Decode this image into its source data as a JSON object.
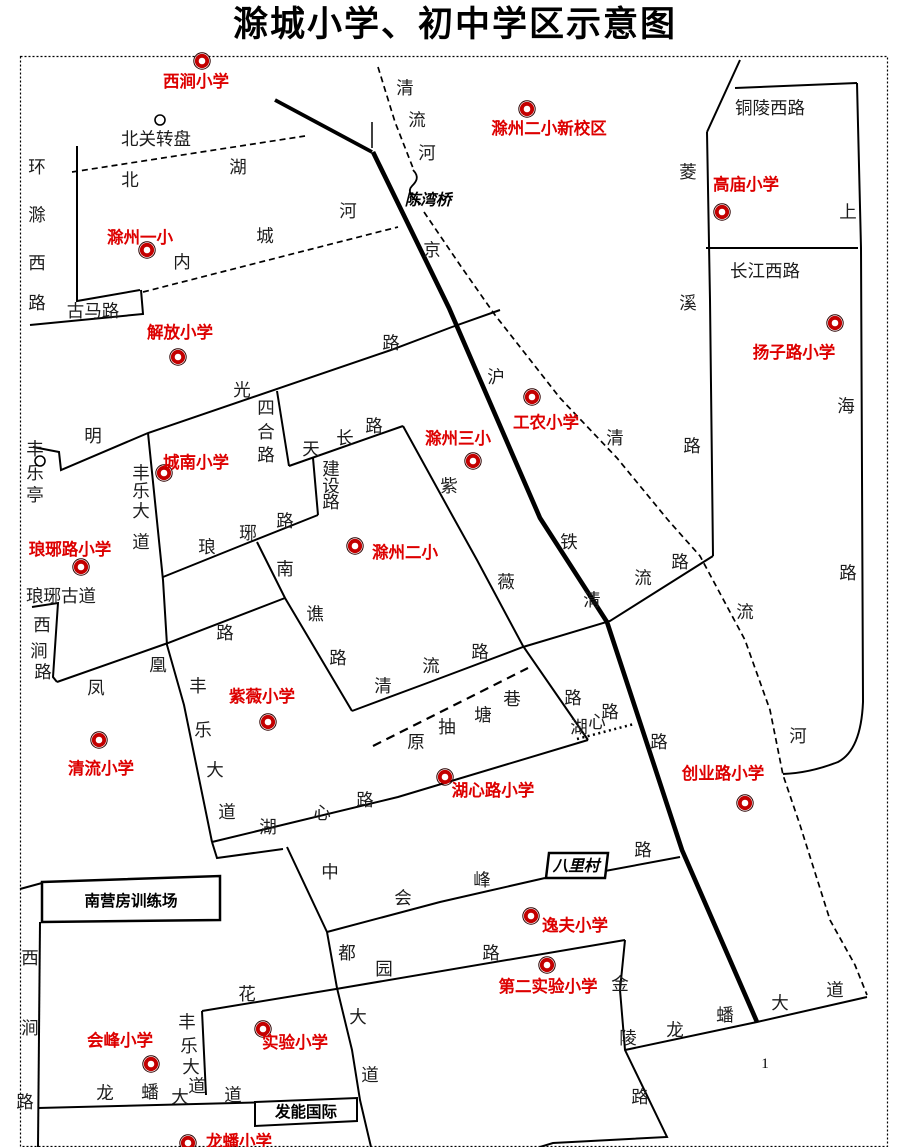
{
  "title": "滁城小学、初中学区示意图",
  "page_number": "1",
  "colors": {
    "school_label_red": "#dd0000",
    "school_marker_red": "#c40000",
    "road_line_black": "#000000",
    "road_label_gray": "#1c1c1c",
    "background": "#ffffff"
  },
  "schools": [
    {
      "name": "西涧小学",
      "label": {
        "x": 196,
        "y": 81
      },
      "marker": {
        "x": 202,
        "y": 61
      }
    },
    {
      "name": "滁州二小新校区",
      "label": {
        "x": 549,
        "y": 128
      },
      "marker": {
        "x": 527,
        "y": 109
      }
    },
    {
      "name": "高庙小学",
      "label": {
        "x": 746,
        "y": 184
      },
      "marker": {
        "x": 722,
        "y": 212
      }
    },
    {
      "name": "滁州一小",
      "label": {
        "x": 140,
        "y": 237
      },
      "marker": {
        "x": 147,
        "y": 250
      }
    },
    {
      "name": "解放小学",
      "label": {
        "x": 180,
        "y": 332
      },
      "marker": {
        "x": 178,
        "y": 357
      }
    },
    {
      "name": "扬子路小学",
      "label": {
        "x": 794,
        "y": 352
      },
      "marker": {
        "x": 835,
        "y": 323
      }
    },
    {
      "name": "工农小学",
      "label": {
        "x": 546,
        "y": 422
      },
      "marker": {
        "x": 532,
        "y": 397
      }
    },
    {
      "name": "滁州三小",
      "label": {
        "x": 458,
        "y": 438
      },
      "marker": {
        "x": 473,
        "y": 461
      }
    },
    {
      "name": "城南小学",
      "label": {
        "x": 196,
        "y": 462
      },
      "marker": {
        "x": 164,
        "y": 473
      }
    },
    {
      "name": "琅琊路小学",
      "label": {
        "x": 70,
        "y": 549
      },
      "marker": {
        "x": 81,
        "y": 567
      }
    },
    {
      "name": "滁州二小",
      "label": {
        "x": 405,
        "y": 552
      },
      "marker": {
        "x": 355,
        "y": 546
      }
    },
    {
      "name": "紫薇小学",
      "label": {
        "x": 262,
        "y": 696
      },
      "marker": {
        "x": 268,
        "y": 722
      }
    },
    {
      "name": "清流小学",
      "label": {
        "x": 101,
        "y": 768
      },
      "marker": {
        "x": 99,
        "y": 740
      }
    },
    {
      "name": "湖心路小学",
      "label": {
        "x": 493,
        "y": 790
      },
      "marker": {
        "x": 445,
        "y": 777
      }
    },
    {
      "name": "创业路小学",
      "label": {
        "x": 723,
        "y": 773
      },
      "marker": {
        "x": 745,
        "y": 803
      }
    },
    {
      "name": "逸夫小学",
      "label": {
        "x": 575,
        "y": 925
      },
      "marker": {
        "x": 531,
        "y": 916
      }
    },
    {
      "name": "第二实验小学",
      "label": {
        "x": 548,
        "y": 986
      },
      "marker": {
        "x": 547,
        "y": 965
      }
    },
    {
      "name": "会峰小学",
      "label": {
        "x": 120,
        "y": 1040
      },
      "marker": {
        "x": 151,
        "y": 1064
      }
    },
    {
      "name": "实验小学",
      "label": {
        "x": 295,
        "y": 1042
      },
      "marker": {
        "x": 263,
        "y": 1029
      }
    },
    {
      "name": "龙蟠小学",
      "label": {
        "x": 239,
        "y": 1141
      },
      "marker": {
        "x": 188,
        "y": 1143
      }
    }
  ],
  "road_labels": [
    {
      "name": "北关转盘",
      "x": 156,
      "y": 139
    },
    {
      "name": "古马路",
      "x": 93,
      "y": 311
    },
    {
      "name": "琅琊古道",
      "x": 61,
      "y": 596
    },
    {
      "name": "铜陵西路",
      "x": 770,
      "y": 108
    },
    {
      "name": "长江西路",
      "x": 765,
      "y": 271
    }
  ],
  "road_char_labels": [
    {
      "name": "环滁西路",
      "chars": [
        {
          "c": "环",
          "x": 37,
          "y": 167
        },
        {
          "c": "滁",
          "x": 37,
          "y": 215
        },
        {
          "c": "西",
          "x": 37,
          "y": 263
        },
        {
          "c": "路",
          "x": 37,
          "y": 303
        }
      ]
    },
    {
      "name": "清流河(上)",
      "chars": [
        {
          "c": "清",
          "x": 405,
          "y": 88
        },
        {
          "c": "流",
          "x": 417,
          "y": 120
        },
        {
          "c": "河",
          "x": 427,
          "y": 153
        }
      ]
    },
    {
      "name": "北湖",
      "chars": [
        {
          "c": "北",
          "x": 130,
          "y": 180
        },
        {
          "c": "湖",
          "x": 238,
          "y": 167
        }
      ]
    },
    {
      "name": "内城河",
      "chars": [
        {
          "c": "内",
          "x": 182,
          "y": 262
        },
        {
          "c": "城",
          "x": 265,
          "y": 236
        },
        {
          "c": "河",
          "x": 348,
          "y": 211
        }
      ]
    },
    {
      "name": "京沪铁路",
      "chars": [
        {
          "c": "京",
          "x": 432,
          "y": 250
        },
        {
          "c": "沪",
          "x": 496,
          "y": 377
        },
        {
          "c": "铁",
          "x": 569,
          "y": 542
        },
        {
          "c": "路",
          "x": 659,
          "y": 742
        }
      ]
    },
    {
      "name": "菱溪路",
      "chars": [
        {
          "c": "菱",
          "x": 688,
          "y": 172
        },
        {
          "c": "溪",
          "x": 688,
          "y": 303
        },
        {
          "c": "路",
          "x": 692,
          "y": 446
        }
      ]
    },
    {
      "name": "上海路",
      "chars": [
        {
          "c": "上",
          "x": 848,
          "y": 212
        },
        {
          "c": "海",
          "x": 846,
          "y": 406
        },
        {
          "c": "路",
          "x": 848,
          "y": 573
        }
      ]
    },
    {
      "name": "明光路",
      "chars": [
        {
          "c": "明",
          "x": 93,
          "y": 436
        },
        {
          "c": "光",
          "x": 242,
          "y": 390
        },
        {
          "c": "路",
          "x": 391,
          "y": 343
        }
      ]
    },
    {
      "name": "四合路",
      "chars": [
        {
          "c": "四",
          "x": 266,
          "y": 408
        },
        {
          "c": "合",
          "x": 266,
          "y": 432
        },
        {
          "c": "路",
          "x": 266,
          "y": 455
        }
      ]
    },
    {
      "name": "天长路",
      "chars": [
        {
          "c": "天",
          "x": 311,
          "y": 449
        },
        {
          "c": "长",
          "x": 345,
          "y": 438
        },
        {
          "c": "路",
          "x": 374,
          "y": 426
        }
      ]
    },
    {
      "name": "建设路",
      "chars": [
        {
          "c": "建",
          "x": 331,
          "y": 469
        },
        {
          "c": "设",
          "x": 331,
          "y": 486
        },
        {
          "c": "路",
          "x": 331,
          "y": 502
        }
      ]
    },
    {
      "name": "丰乐亭",
      "chars": [
        {
          "c": "丰",
          "x": 35,
          "y": 449
        },
        {
          "c": "乐",
          "x": 35,
          "y": 473
        },
        {
          "c": "亭",
          "x": 35,
          "y": 495
        }
      ]
    },
    {
      "name": "丰乐大道(北)",
      "chars": [
        {
          "c": "丰",
          "x": 141,
          "y": 473
        },
        {
          "c": "乐",
          "x": 141,
          "y": 491
        },
        {
          "c": "大",
          "x": 141,
          "y": 511
        },
        {
          "c": "道",
          "x": 141,
          "y": 542
        }
      ]
    },
    {
      "name": "琅琊路",
      "chars": [
        {
          "c": "琅",
          "x": 207,
          "y": 547
        },
        {
          "c": "琊",
          "x": 248,
          "y": 533
        },
        {
          "c": "路",
          "x": 285,
          "y": 521
        }
      ]
    },
    {
      "name": "紫薇路",
      "chars": [
        {
          "c": "紫",
          "x": 449,
          "y": 486
        },
        {
          "c": "薇",
          "x": 506,
          "y": 582
        },
        {
          "c": "路",
          "x": 573,
          "y": 698
        }
      ]
    },
    {
      "name": "南谯路",
      "chars": [
        {
          "c": "南",
          "x": 285,
          "y": 569
        },
        {
          "c": "谯",
          "x": 315,
          "y": 614
        },
        {
          "c": "路",
          "x": 338,
          "y": 658
        }
      ]
    },
    {
      "name": "凤凰路",
      "chars": [
        {
          "c": "凤",
          "x": 96,
          "y": 688
        },
        {
          "c": "凰",
          "x": 158,
          "y": 665
        },
        {
          "c": "路",
          "x": 225,
          "y": 633
        }
      ]
    },
    {
      "name": "清流路(西)",
      "chars": [
        {
          "c": "清",
          "x": 383,
          "y": 686
        },
        {
          "c": "流",
          "x": 431,
          "y": 666
        },
        {
          "c": "路",
          "x": 480,
          "y": 652
        }
      ]
    },
    {
      "name": "清流路(东)",
      "chars": [
        {
          "c": "清",
          "x": 592,
          "y": 600
        },
        {
          "c": "流",
          "x": 643,
          "y": 578
        },
        {
          "c": "路",
          "x": 680,
          "y": 562
        }
      ]
    },
    {
      "name": "清流河(下)",
      "chars": [
        {
          "c": "清",
          "x": 615,
          "y": 438
        },
        {
          "c": "流",
          "x": 745,
          "y": 612
        },
        {
          "c": "河",
          "x": 798,
          "y": 736
        }
      ]
    },
    {
      "name": "西涧路(北)",
      "chars": [
        {
          "c": "西",
          "x": 42,
          "y": 625
        },
        {
          "c": "涧",
          "x": 39,
          "y": 651
        },
        {
          "c": "路",
          "x": 43,
          "y": 672
        }
      ]
    },
    {
      "name": "西涧路(南)",
      "chars": [
        {
          "c": "西",
          "x": 30,
          "y": 958
        },
        {
          "c": "涧",
          "x": 30,
          "y": 1028
        },
        {
          "c": "路",
          "x": 25,
          "y": 1102
        }
      ]
    },
    {
      "name": "丰乐大道(中)",
      "chars": [
        {
          "c": "丰",
          "x": 198,
          "y": 686
        },
        {
          "c": "乐",
          "x": 203,
          "y": 730
        },
        {
          "c": "大",
          "x": 215,
          "y": 770
        },
        {
          "c": "道",
          "x": 227,
          "y": 812
        }
      ]
    },
    {
      "name": "丰乐大道(南)",
      "chars": [
        {
          "c": "丰",
          "x": 187,
          "y": 1022
        },
        {
          "c": "乐",
          "x": 189,
          "y": 1046
        },
        {
          "c": "大",
          "x": 191,
          "y": 1067
        },
        {
          "c": "道",
          "x": 197,
          "y": 1086
        }
      ]
    },
    {
      "name": "湖心路(西)",
      "chars": [
        {
          "c": "湖",
          "x": 268,
          "y": 827
        },
        {
          "c": "心",
          "x": 322,
          "y": 813
        },
        {
          "c": "路",
          "x": 365,
          "y": 800
        }
      ]
    },
    {
      "name": "湖心路(中)",
      "chars": [
        {
          "c": "湖",
          "x": 579,
          "y": 727
        },
        {
          "c": "心",
          "x": 597,
          "y": 722
        },
        {
          "c": "路",
          "x": 610,
          "y": 712
        }
      ]
    },
    {
      "name": "原抽塘巷",
      "chars": [
        {
          "c": "原",
          "x": 416,
          "y": 742
        },
        {
          "c": "抽",
          "x": 447,
          "y": 727
        },
        {
          "c": "塘",
          "x": 483,
          "y": 715
        },
        {
          "c": "巷",
          "x": 512,
          "y": 699
        }
      ]
    },
    {
      "name": "中都大道",
      "chars": [
        {
          "c": "中",
          "x": 330,
          "y": 872
        },
        {
          "c": "都",
          "x": 347,
          "y": 953
        },
        {
          "c": "大",
          "x": 358,
          "y": 1017
        },
        {
          "c": "道",
          "x": 370,
          "y": 1075
        }
      ]
    },
    {
      "name": "会峰路",
      "chars": [
        {
          "c": "会",
          "x": 403,
          "y": 898
        },
        {
          "c": "峰",
          "x": 482,
          "y": 880
        },
        {
          "c": "路",
          "x": 643,
          "y": 850
        }
      ]
    },
    {
      "name": "花园路",
      "chars": [
        {
          "c": "花",
          "x": 247,
          "y": 994
        },
        {
          "c": "园",
          "x": 384,
          "y": 969
        },
        {
          "c": "路",
          "x": 491,
          "y": 953
        }
      ]
    },
    {
      "name": "龙蟠大道(西)",
      "chars": [
        {
          "c": "龙",
          "x": 105,
          "y": 1093
        },
        {
          "c": "蟠",
          "x": 150,
          "y": 1092
        },
        {
          "c": "大",
          "x": 180,
          "y": 1097
        },
        {
          "c": "道",
          "x": 233,
          "y": 1095
        }
      ]
    },
    {
      "name": "龙蟠大道(东)",
      "chars": [
        {
          "c": "龙",
          "x": 675,
          "y": 1030
        },
        {
          "c": "蟠",
          "x": 725,
          "y": 1015
        },
        {
          "c": "大",
          "x": 780,
          "y": 1003
        },
        {
          "c": "道",
          "x": 835,
          "y": 990
        }
      ]
    },
    {
      "name": "金陵路",
      "chars": [
        {
          "c": "金",
          "x": 620,
          "y": 984
        },
        {
          "c": "陵",
          "x": 628,
          "y": 1038
        },
        {
          "c": "路",
          "x": 640,
          "y": 1097
        }
      ]
    }
  ],
  "landmarks": [
    {
      "name": "陈湾桥",
      "x": 428,
      "y": 200,
      "boxed": false,
      "italic": true
    },
    {
      "name": "八里村",
      "x": 576,
      "y": 866,
      "boxed": true,
      "italic": true
    },
    {
      "name": "南营房训练场",
      "x": 131,
      "y": 901,
      "boxed": true,
      "italic": false
    },
    {
      "name": "发能国际",
      "x": 306,
      "y": 1112,
      "boxed": true,
      "italic": false
    }
  ],
  "map_symbols": [
    {
      "name": "roundabout-circle",
      "x": 160,
      "y": 120
    },
    {
      "name": "pavilion-circle",
      "x": 40,
      "y": 461
    }
  ]
}
